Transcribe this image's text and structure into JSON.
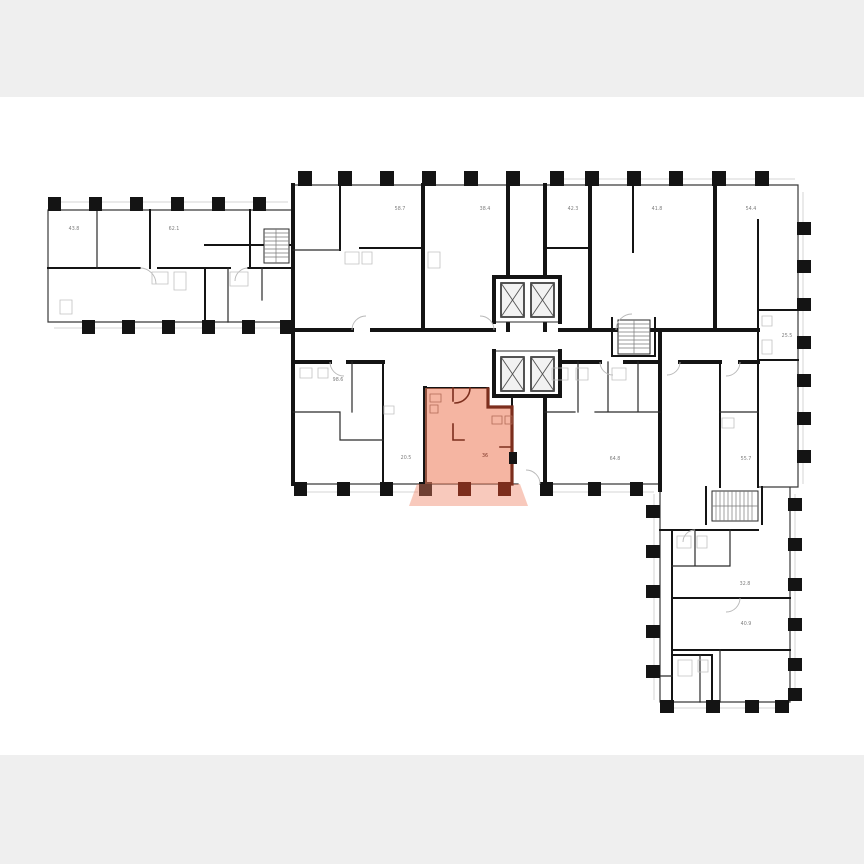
{
  "scene": {
    "type": "building-floor-plan",
    "background": "#ffffff",
    "letterbox_color": "#efefef"
  },
  "colors": {
    "wall": "#141414",
    "facade": "#3a3a3a",
    "light_detail": "#d6d6d6",
    "label": "#7d7d7d",
    "highlight_fill": "#ee7f5f",
    "highlight_wall": "#7c2e1d",
    "highlight_label": "#80382a"
  },
  "rooms": [
    {
      "id": "room-43-8",
      "area": "43.8"
    },
    {
      "id": "room-62-1",
      "area": "62.1"
    },
    {
      "id": "room-58-7",
      "area": "58.7"
    },
    {
      "id": "room-38-4",
      "area": "38.4"
    },
    {
      "id": "room-42-3",
      "area": "42.3"
    },
    {
      "id": "room-41-8",
      "area": "41.8"
    },
    {
      "id": "room-54-4",
      "area": "54.4"
    },
    {
      "id": "room-25-5",
      "area": "25.5"
    },
    {
      "id": "room-98-6",
      "area": "98.6"
    },
    {
      "id": "room-20-5",
      "area": "20.5"
    },
    {
      "id": "room-64-8",
      "area": "64.8"
    },
    {
      "id": "room-55-7",
      "area": "55.7"
    },
    {
      "id": "room-32-8",
      "area": "32.8"
    },
    {
      "id": "room-40-9",
      "area": "40.9"
    }
  ],
  "highlighted_apartment": {
    "id": "apartment-36",
    "area": "36"
  }
}
